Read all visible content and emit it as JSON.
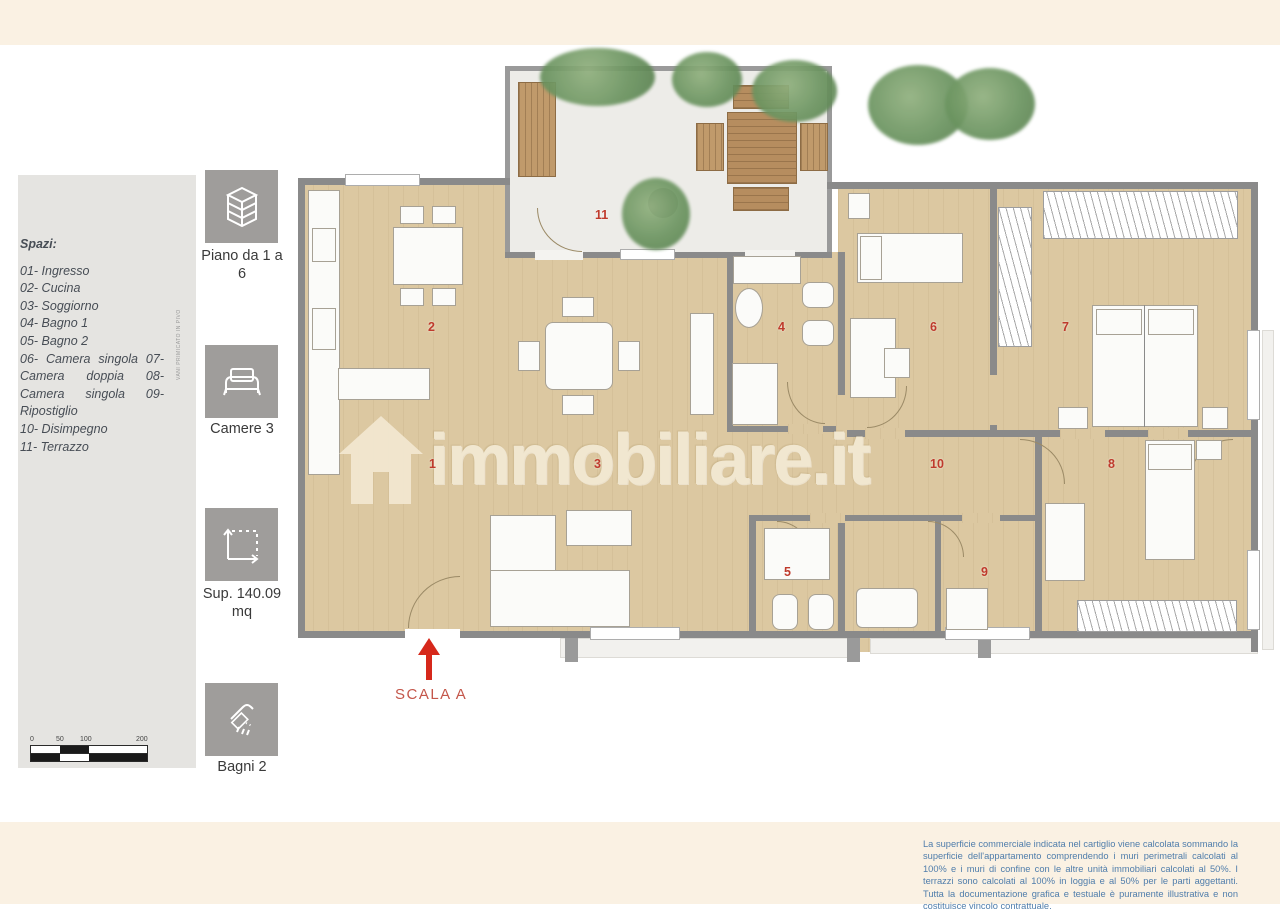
{
  "page": {
    "top_band_color": "#faf1e3",
    "accent_red": "#bf3a2c"
  },
  "legend": {
    "title": "Spazi:",
    "lines": [
      "01- Ingresso",
      "02- Cucina",
      "03- Soggiorno",
      "04- Bagno 1",
      "05- Bagno 2",
      "06- Camera singola 07- Camera doppia 08- Camera singola 09- Ripostiglio",
      "10- Disimpegno",
      "11- Terrazzo"
    ],
    "side_note": "VANI PRIMICATO IN PIVO"
  },
  "stats": [
    {
      "icon": "building-icon",
      "label": "Piano da 1 a 6"
    },
    {
      "icon": "bed-icon",
      "label": "Camere 3"
    },
    {
      "icon": "area-icon",
      "label": "Sup. 140.09 mq"
    },
    {
      "icon": "shower-icon",
      "label": "Bagni 2"
    }
  ],
  "scalebar": {
    "labels": [
      "0",
      "50",
      "100",
      "200"
    ]
  },
  "plan": {
    "watermark": "immobiliare.it",
    "scala_label": "SCALA A",
    "room_numbers": [
      "1",
      "2",
      "3",
      "4",
      "5",
      "6",
      "7",
      "8",
      "9",
      "10",
      "11"
    ]
  },
  "disclaimer": {
    "text": "La superficie commerciale indicata nel cartiglio viene calcolata sommando la superficie dell'appartamento comprendendo i muri perimetrali calcolati al 100% e i muri di confine con le altre unità immobiliari calcolati al 50%. I terrazzi sono calcolati al 100% in loggia e al 50% per le parti aggettanti. Tutta la documentazione grafica e testuale è puramente illustrativa e non costituisce vincolo contrattuale."
  }
}
